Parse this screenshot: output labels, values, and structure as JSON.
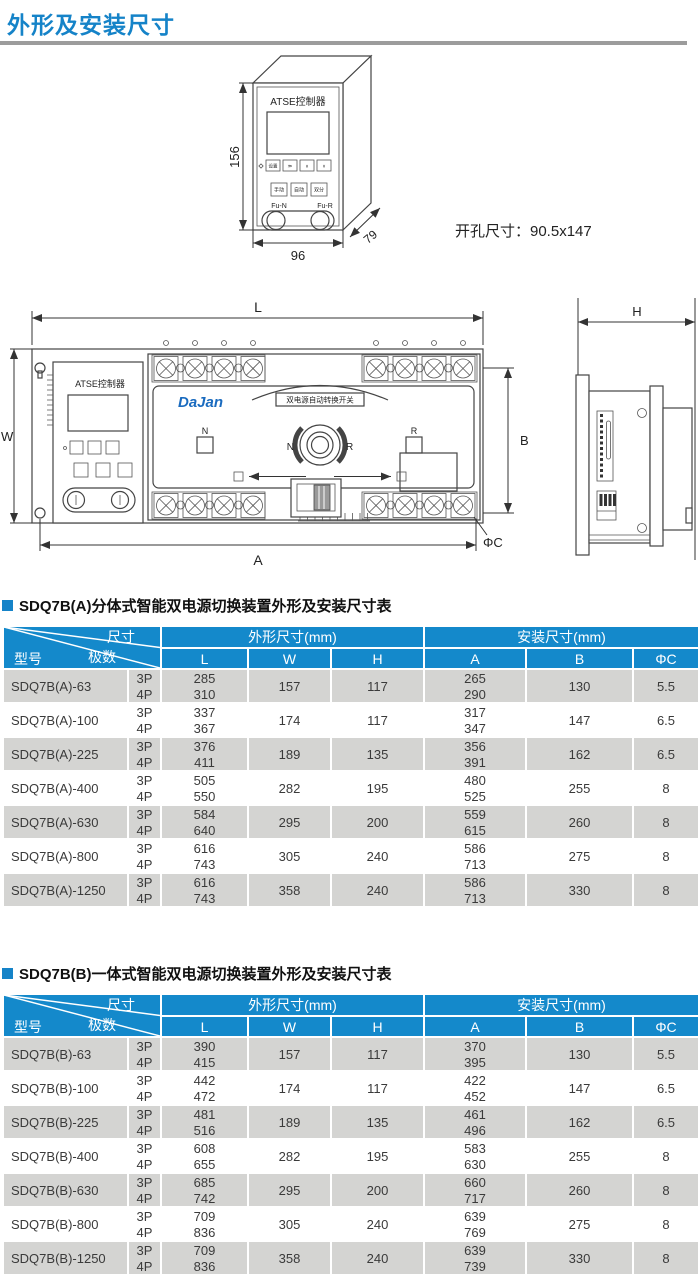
{
  "page": {
    "title": "外形及安装尺寸",
    "colors": {
      "accent": "#1583c8",
      "header": "#1489cb",
      "rowgray": "#d4d4d2",
      "logo": "#1a6bbf",
      "rule": "#9c9c9c"
    }
  },
  "controller_drawing": {
    "label": "ATSE控制器",
    "buttons_row1": [
      "设置",
      "≫",
      "∧",
      "∨"
    ],
    "buttons_row2": [
      "手动",
      "自动",
      "双分"
    ],
    "fuse_left": "Fu-N",
    "fuse_right": "Fu-R",
    "dim_height": "156",
    "dim_width": "96",
    "dim_depth": "79",
    "cutout_note": "开孔尺寸：90.5x147"
  },
  "main_drawing": {
    "controller_label": "ATSE控制器",
    "logo": "DaJan",
    "panel_label": "双电源自动转换开关",
    "knob_left": "N",
    "knob_right": "R",
    "indicator_left": "N",
    "indicator_right": "R",
    "dim_L": "L",
    "dim_W": "W",
    "dim_H": "H",
    "dim_A": "A",
    "dim_B": "B",
    "dim_C": "ΦC"
  },
  "tables": [
    {
      "title": "SDQ7B(A)分体式智能双电源切换装置外形及安装尺寸表",
      "corner": {
        "size": "尺寸",
        "model": "型号",
        "poles": "极数"
      },
      "group_outline": "外形尺寸(mm)",
      "group_install": "安装尺寸(mm)",
      "columns": [
        "L",
        "W",
        "H",
        "A",
        "B",
        "ΦC"
      ],
      "rows": [
        {
          "model": "SDQ7B(A)-63",
          "poles": [
            "3P",
            "4P"
          ],
          "L": [
            "285",
            "310"
          ],
          "W": "157",
          "H": "117",
          "A": [
            "265",
            "290"
          ],
          "B": "130",
          "C": "5.5"
        },
        {
          "model": "SDQ7B(A)-100",
          "poles": [
            "3P",
            "4P"
          ],
          "L": [
            "337",
            "367"
          ],
          "W": "174",
          "H": "117",
          "A": [
            "317",
            "347"
          ],
          "B": "147",
          "C": "6.5"
        },
        {
          "model": "SDQ7B(A)-225",
          "poles": [
            "3P",
            "4P"
          ],
          "L": [
            "376",
            "411"
          ],
          "W": "189",
          "H": "135",
          "A": [
            "356",
            "391"
          ],
          "B": "162",
          "C": "6.5"
        },
        {
          "model": "SDQ7B(A)-400",
          "poles": [
            "3P",
            "4P"
          ],
          "L": [
            "505",
            "550"
          ],
          "W": "282",
          "H": "195",
          "A": [
            "480",
            "525"
          ],
          "B": "255",
          "C": "8"
        },
        {
          "model": "SDQ7B(A)-630",
          "poles": [
            "3P",
            "4P"
          ],
          "L": [
            "584",
            "640"
          ],
          "W": "295",
          "H": "200",
          "A": [
            "559",
            "615"
          ],
          "B": "260",
          "C": "8"
        },
        {
          "model": "SDQ7B(A)-800",
          "poles": [
            "3P",
            "4P"
          ],
          "L": [
            "616",
            "743"
          ],
          "W": "305",
          "H": "240",
          "A": [
            "586",
            "713"
          ],
          "B": "275",
          "C": "8"
        },
        {
          "model": "SDQ7B(A)-1250",
          "poles": [
            "3P",
            "4P"
          ],
          "L": [
            "616",
            "743"
          ],
          "W": "358",
          "H": "240",
          "A": [
            "586",
            "713"
          ],
          "B": "330",
          "C": "8"
        }
      ]
    },
    {
      "title": "SDQ7B(B)一体式智能双电源切换装置外形及安装尺寸表",
      "corner": {
        "size": "尺寸",
        "model": "型号",
        "poles": "极数"
      },
      "group_outline": "外形尺寸(mm)",
      "group_install": "安装尺寸(mm)",
      "columns": [
        "L",
        "W",
        "H",
        "A",
        "B",
        "ΦC"
      ],
      "rows": [
        {
          "model": "SDQ7B(B)-63",
          "poles": [
            "3P",
            "4P"
          ],
          "L": [
            "390",
            "415"
          ],
          "W": "157",
          "H": "117",
          "A": [
            "370",
            "395"
          ],
          "B": "130",
          "C": "5.5"
        },
        {
          "model": "SDQ7B(B)-100",
          "poles": [
            "3P",
            "4P"
          ],
          "L": [
            "442",
            "472"
          ],
          "W": "174",
          "H": "117",
          "A": [
            "422",
            "452"
          ],
          "B": "147",
          "C": "6.5"
        },
        {
          "model": "SDQ7B(B)-225",
          "poles": [
            "3P",
            "4P"
          ],
          "L": [
            "481",
            "516"
          ],
          "W": "189",
          "H": "135",
          "A": [
            "461",
            "496"
          ],
          "B": "162",
          "C": "6.5"
        },
        {
          "model": "SDQ7B(B)-400",
          "poles": [
            "3P",
            "4P"
          ],
          "L": [
            "608",
            "655"
          ],
          "W": "282",
          "H": "195",
          "A": [
            "583",
            "630"
          ],
          "B": "255",
          "C": "8"
        },
        {
          "model": "SDQ7B(B)-630",
          "poles": [
            "3P",
            "4P"
          ],
          "L": [
            "685",
            "742"
          ],
          "W": "295",
          "H": "200",
          "A": [
            "660",
            "717"
          ],
          "B": "260",
          "C": "8"
        },
        {
          "model": "SDQ7B(B)-800",
          "poles": [
            "3P",
            "4P"
          ],
          "L": [
            "709",
            "836"
          ],
          "W": "305",
          "H": "240",
          "A": [
            "639",
            "769"
          ],
          "B": "275",
          "C": "8"
        },
        {
          "model": "SDQ7B(B)-1250",
          "poles": [
            "3P",
            "4P"
          ],
          "L": [
            "709",
            "836"
          ],
          "W": "358",
          "H": "240",
          "A": [
            "639",
            "739"
          ],
          "B": "330",
          "C": "8"
        }
      ]
    }
  ]
}
